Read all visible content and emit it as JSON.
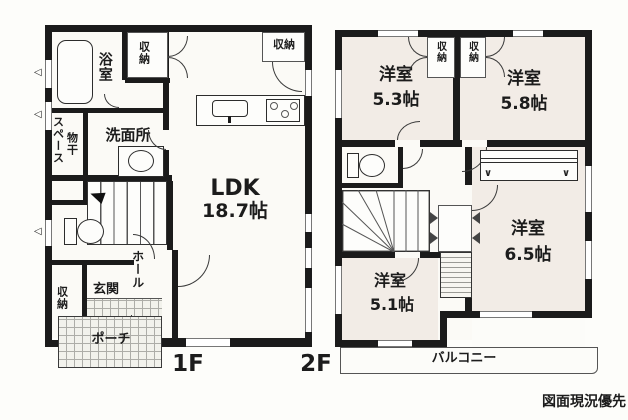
{
  "meta": {
    "note": "図面現況優先"
  },
  "colors": {
    "wall": "#1b1b1b",
    "floor2_room_fill": "#f2ece6",
    "floor1_fill": "#fbfaf6"
  },
  "icons": {
    "vent": "◁",
    "hanger": "∨",
    "arrow": "◄"
  },
  "floor1": {
    "label": "1F",
    "rooms": {
      "bath": "浴室",
      "bath_closet": "収納",
      "washroom": "洗面所",
      "drying_col_right": "物干",
      "drying_col_left": "スペース",
      "ldk_name": "LDK",
      "ldk_size": "18.7帖",
      "ldk_closet": "収納",
      "hall": "ホール",
      "entrance": "玄関",
      "entrance_closet": "収納",
      "porch": "ポーチ"
    }
  },
  "floor2": {
    "label": "2F",
    "rooms": {
      "room_a_name": "洋室",
      "room_a_size": "5.3帖",
      "closet_a": "収納",
      "closet_b": "収納",
      "room_b_name": "洋室",
      "room_b_size": "5.8帖",
      "room_c_name": "洋室",
      "room_c_size": "6.5帖",
      "room_d_name": "洋室",
      "room_d_size": "5.1帖",
      "balcony": "バルコニー"
    }
  }
}
